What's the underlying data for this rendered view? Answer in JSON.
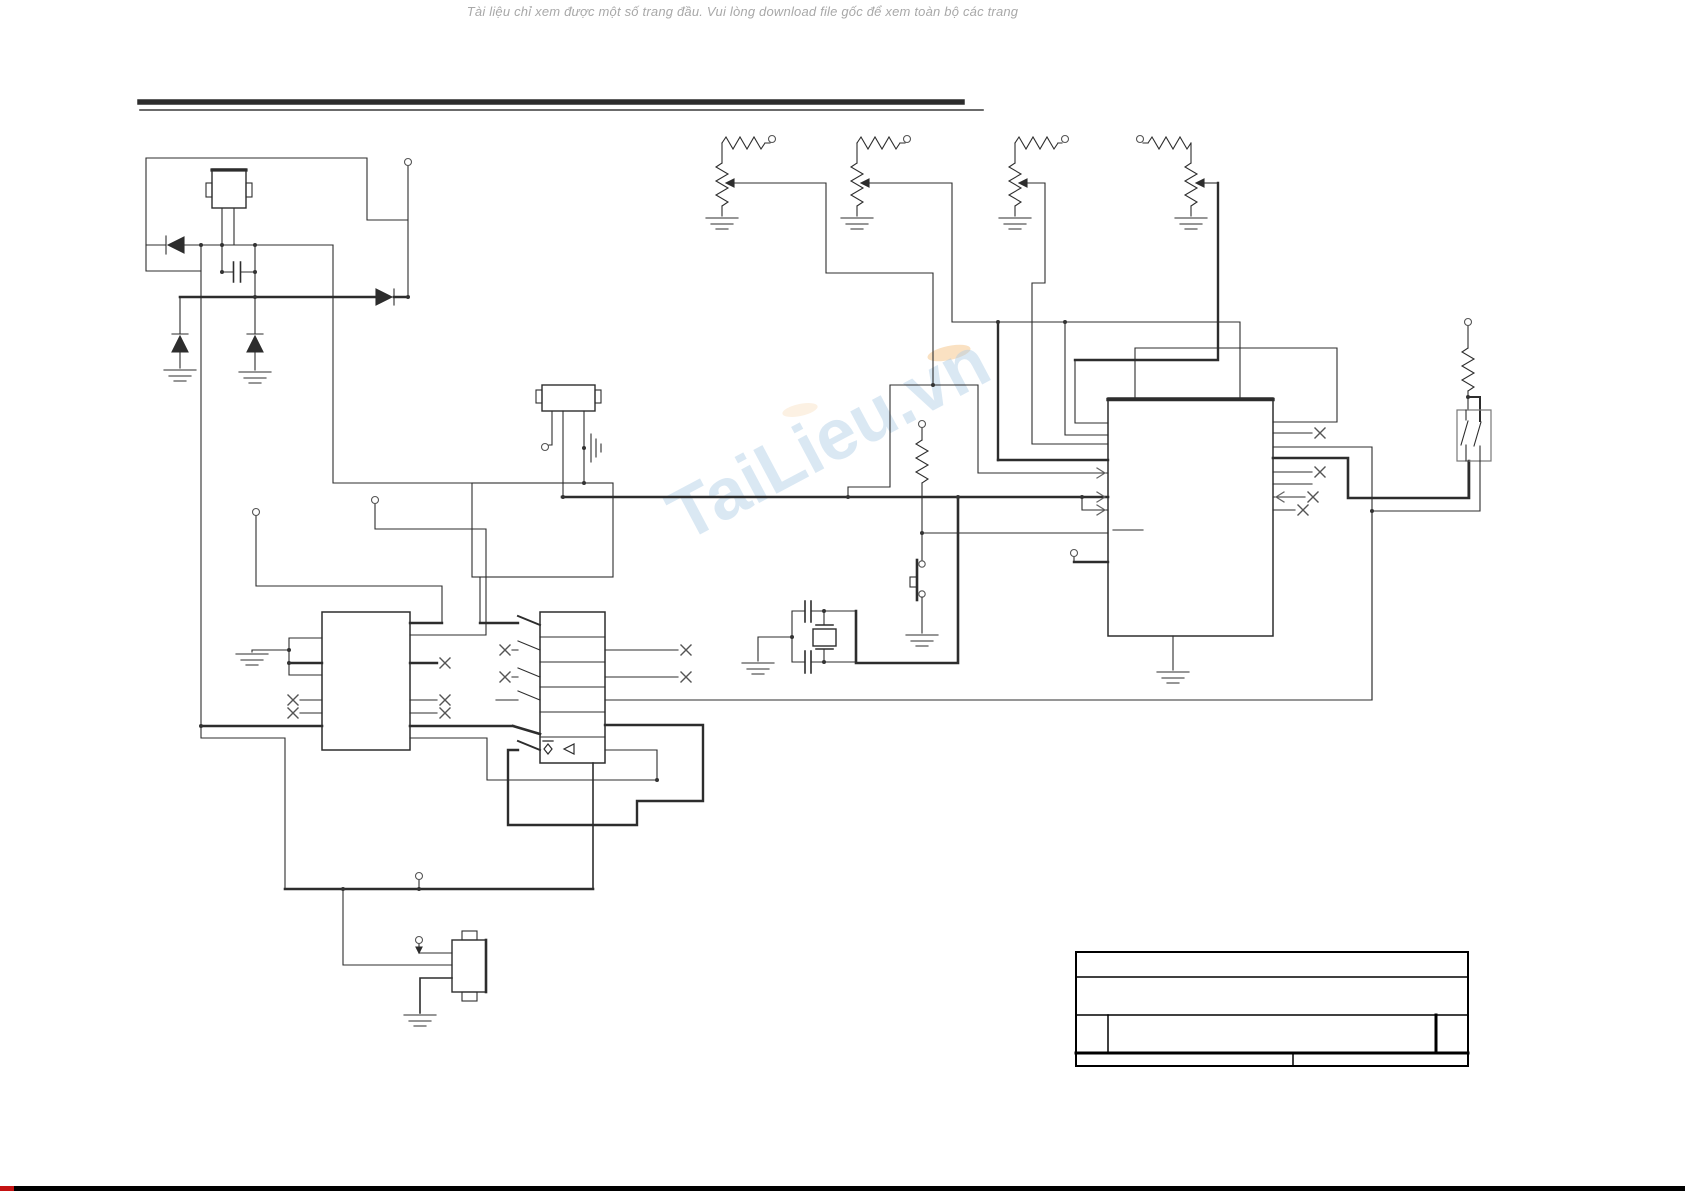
{
  "page": {
    "notice": "Tài liệu chỉ xem được một số trang đầu. Vui lòng download file gốc để xem toàn bộ các trang",
    "background": "#ffffff"
  },
  "watermark": {
    "text": "TaiLieu.vn",
    "color": "#aecde6",
    "accent_color": "#f5c98f"
  },
  "schematic": {
    "ink": "#2d2d2d",
    "components": [
      "transformer",
      "rectifier-diode",
      "filter-capacitor",
      "potentiometer",
      "ceramic-resonator",
      "crystal-oscillator",
      "load-capacitor",
      "pushbutton",
      "pull-up-resistor",
      "main-ic",
      "driver-ic",
      "multi-pin-connector",
      "dip-switch",
      "power-jack",
      "ground-symbol",
      "terminal",
      "no-connect-mark"
    ]
  },
  "footer": {
    "bar_color": "#000000",
    "progress_color": "#c41212"
  }
}
